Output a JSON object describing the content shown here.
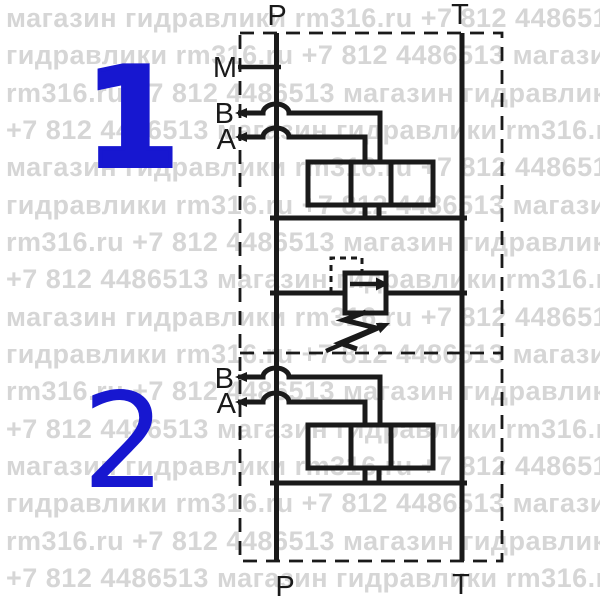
{
  "diagram": {
    "kind": "hydraulic sectional directional valve schematic",
    "main_ports": {
      "p_top": "P",
      "t_top": "T",
      "p_bottom": "P",
      "t_bottom": "T"
    },
    "sections": [
      {
        "number": "1",
        "ports": {
          "m": "M",
          "b": "B",
          "a": "A"
        }
      },
      {
        "number": "2",
        "ports": {
          "b": "B",
          "a": "A"
        }
      }
    ]
  },
  "colors": {
    "line": "#1a1a1a",
    "section_number_blue": "#1717d0",
    "watermark_gray": "#d6d6d6",
    "background": "#ffffff"
  },
  "watermark": {
    "rows": [
      "магазин гидравлики rm316.ru +7 812 4486513 магазин гидравлики",
      "гидравлики rm316.ru +7 812 4486513 магазин гидравлики rm316.ru",
      "rm316.ru +7 812 4486513 магазин гидравлики rm316.ru +7 812 4486513",
      "+7 812 4486513 магазин гидравлики rm316.ru +7 812 4486513 магазин",
      "магазин гидравлики rm316.ru +7 812 4486513 магазин гидравлики",
      "гидравлики rm316.ru +7 812 4486513 магазин гидравлики rm316.ru",
      "rm316.ru +7 812 4486513 магазин гидравлики rm316.ru +7 812 4486513",
      "+7 812 4486513 магазин гидравлики rm316.ru +7 812 4486513 магазин",
      "магазин гидравлики rm316.ru +7 812 4486513 магазин гидравлики",
      "гидравлики rm316.ru +7 812 4486513 магазин гидравлики rm316.ru",
      "rm316.ru +7 812 4486513 магазин гидравлики rm316.ru +7 812 4486513",
      "+7 812 4486513 магазин гидравлики rm316.ru +7 812 4486513 магазин",
      "магазин гидравлики rm316.ru +7 812 4486513 магазин гидравлики",
      "гидравлики rm316.ru +7 812 4486513 магазин гидравлики rm316.ru",
      "rm316.ru +7 812 4486513 магазин гидравлики rm316.ru +7 812 4486513",
      "+7 812 4486513 магазин гидравлики rm316.ru +7 812 4486513 магазин"
    ]
  }
}
